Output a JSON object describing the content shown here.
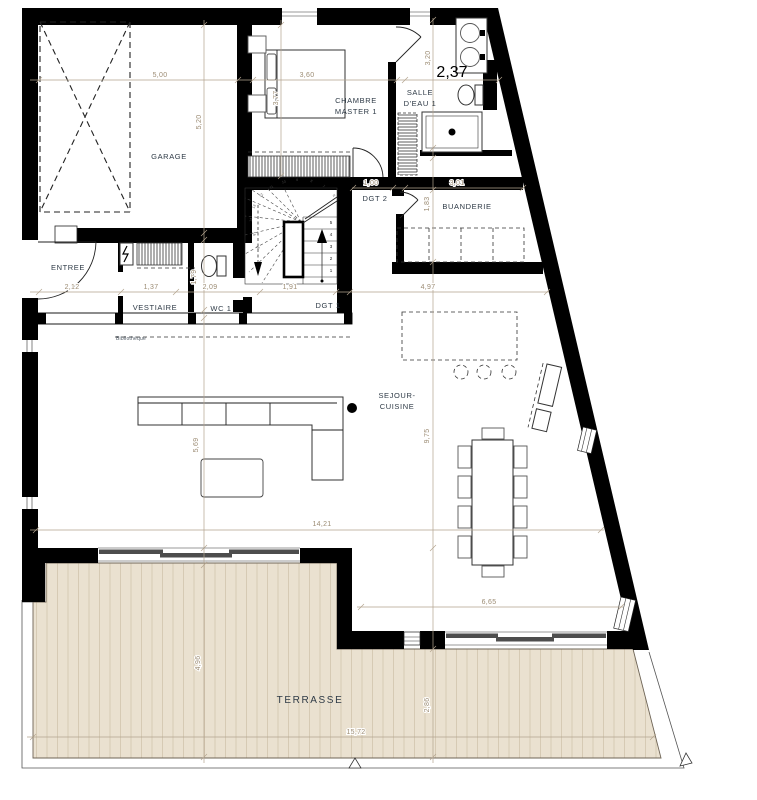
{
  "meta": {
    "type": "architectural-floor-plan",
    "floor": "ground-floor"
  },
  "colors": {
    "wall": "#000000",
    "dimension_line": "#b3a48e",
    "dimension_text": "#9c8c74",
    "room_label": "#2e3a46",
    "terrace_fill": "#eae1d0",
    "terrace_stripe": "#d4c8b1",
    "sliding_door_panel": "#4d4d4d"
  },
  "rooms": {
    "garage": "GARAGE",
    "entree": "ENTREE",
    "vestiaire": "VESTIAIRE",
    "wc1": "WC 1",
    "dgt1": "DGT 1",
    "dgt2": "DGT 2",
    "chambre_line1": "CHAMBRE",
    "chambre_line2": "MASTER 1",
    "salle_line1": "SALLE",
    "salle_line2": "D'EAU 1",
    "buanderie": "BUANDERIE",
    "sejour_line1": "SEJOUR-",
    "sejour_line2": "CUISINE",
    "terrasse": "TERRASSE",
    "bibliotheque": "Bibliothèque"
  },
  "dims": {
    "d500": "5,00",
    "d520": "5,20",
    "d360": "3,60",
    "d377": "3,77",
    "d320": "3,20",
    "d237": "2,37",
    "d100": "1,00",
    "d301": "3,01",
    "d183": "1,83",
    "d212": "2,12",
    "d137": "1,37",
    "d179": "1,79",
    "d209": "2,09",
    "d191": "1,91",
    "d497": "4,97",
    "d975": "9,75",
    "d569": "5,69",
    "d1421": "14,21",
    "d665": "6,65",
    "d496": "4,96",
    "d286": "2,86",
    "d1572": "15,72"
  },
  "stairs": {
    "steps": [
      "1",
      "2",
      "3",
      "4",
      "5"
    ],
    "winders": [
      "6",
      "7",
      "8",
      "9",
      "10",
      "11",
      "12",
      "13",
      "14",
      "15",
      "16"
    ]
  }
}
